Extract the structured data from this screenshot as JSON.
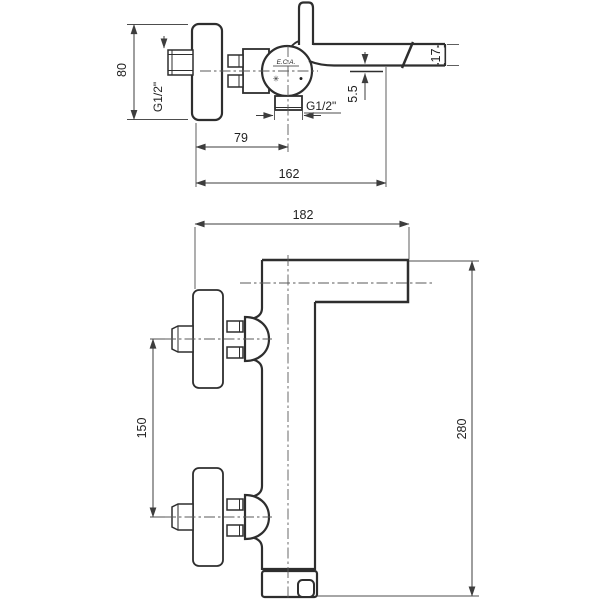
{
  "side_view": {
    "dims": {
      "plate_height": "80",
      "wall_thread": "G1/2\"",
      "outlet_thread": "G1/2\"",
      "wall_to_outlet": "79",
      "wall_to_spout_tip": "162",
      "spout_end_height": "17",
      "spout_underside_offset": "5.5"
    },
    "brand_mark": "E.C.A.",
    "cold_symbol": "✳",
    "hot_symbol": "●"
  },
  "front_view": {
    "dims": {
      "spout_reach": "182",
      "inlet_spacing": "150",
      "overall_height": "280"
    }
  }
}
